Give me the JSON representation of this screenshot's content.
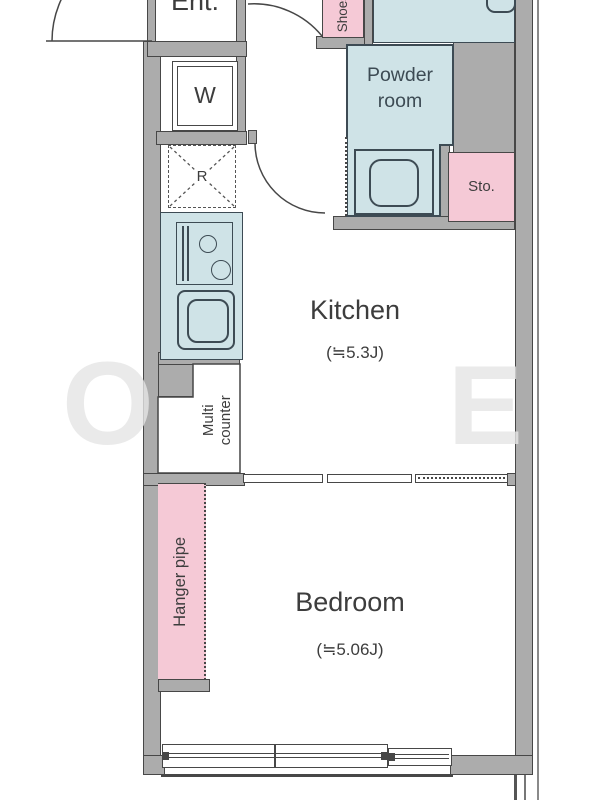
{
  "labels": {
    "entrance": "Ent.",
    "washing_machine": "W",
    "refrigerator": "R",
    "shoes": "Shoes",
    "powder_room": "Powder room",
    "storage": "Sto.",
    "kitchen": "Kitchen",
    "kitchen_size": "(≒5.3J)",
    "multi_counter": "Multi counter",
    "hanger_pipe": "Hanger pipe",
    "bedroom": "Bedroom",
    "bedroom_size": "(≒5.06J)"
  },
  "watermark": {
    "left_letter": "O",
    "right_letter": "E"
  },
  "colors": {
    "wall": "#acacac",
    "line": "#474747",
    "wet": "#cfe3e7",
    "wetline": "#3d4b54",
    "pink": "#f5c9d6",
    "ink": "#3d3d3d",
    "wm": "#e6e6e6"
  }
}
